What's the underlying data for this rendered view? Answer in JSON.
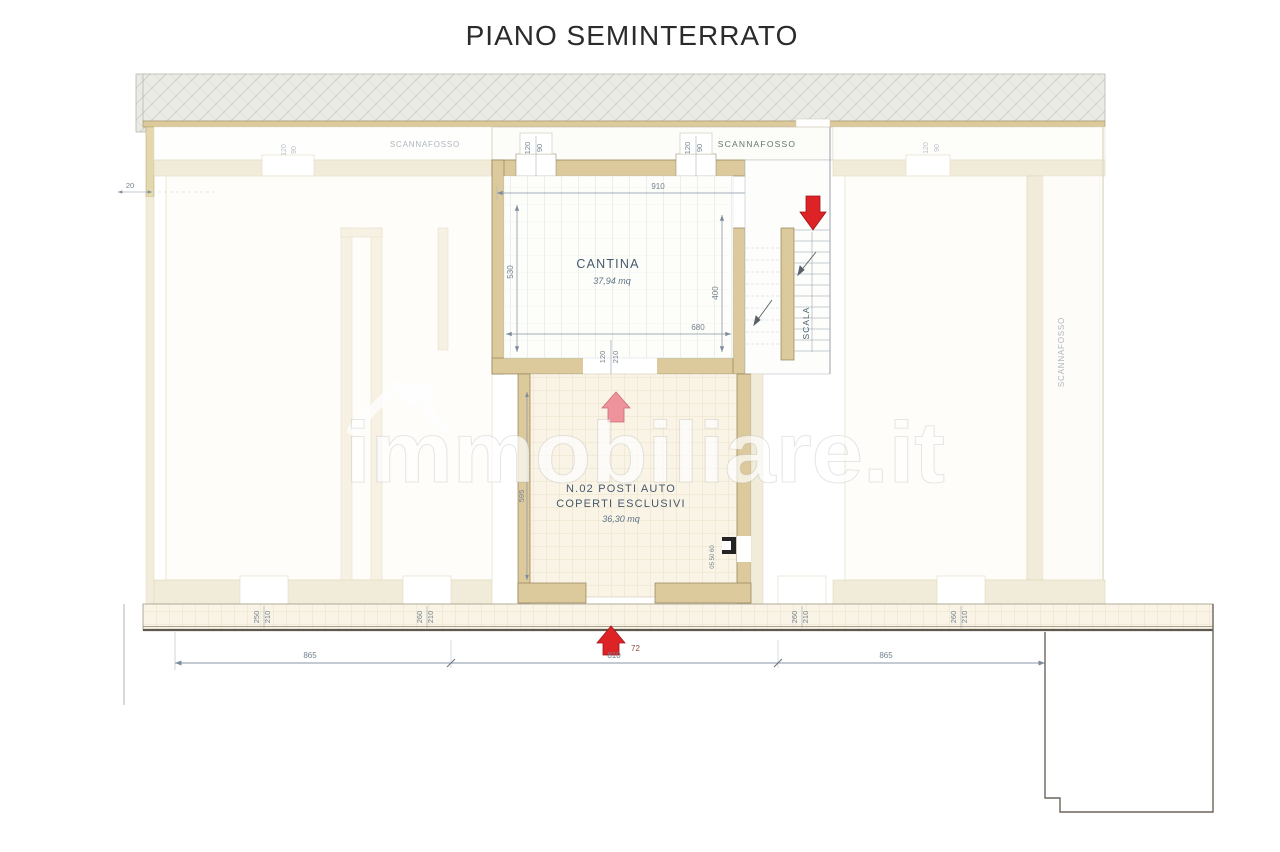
{
  "title": "PIANO SEMINTERRATO",
  "watermark": {
    "text": "immobiliare.it",
    "icon": "house-icon"
  },
  "labels": {
    "scannafosso_center": "SCANNAFOSSO",
    "scannafosso_left_faint": "SCANNAFOSSO",
    "scannafosso_right_vertical": "SCANNAFOSSO",
    "cantina": "CANTINA",
    "cantina_area": "37,94 mq",
    "garage_line1": "N.02 POSTI AUTO",
    "garage_line2": "COPERTI ESCLUSIVI",
    "garage_area": "36,30 mq",
    "scala": "SCALA"
  },
  "dims": {
    "offset_left": "20",
    "top_width": "910",
    "window_w": "120",
    "window_h": "90",
    "cantina_height": "530",
    "stair_height": "400",
    "cantina_width": "680",
    "door_w": "120",
    "door_h": "210",
    "garage_height": "595",
    "side_door": "05 50 60",
    "pair1_a": "250",
    "pair1_b": "210",
    "pair2_a": "260",
    "pair2_b": "210",
    "pair3_a": "260",
    "pair3_b": "210",
    "pair4_a": "260",
    "pair4_b": "210",
    "total_left": "865",
    "total_mid": "810",
    "total_right": "865",
    "entry_width": "72"
  },
  "colors": {
    "arrow_red": "#dd2326",
    "arrow_pink": "#ee929c",
    "wall_active": "#dcc99c",
    "wall_ghost": "#f1ebd9"
  }
}
